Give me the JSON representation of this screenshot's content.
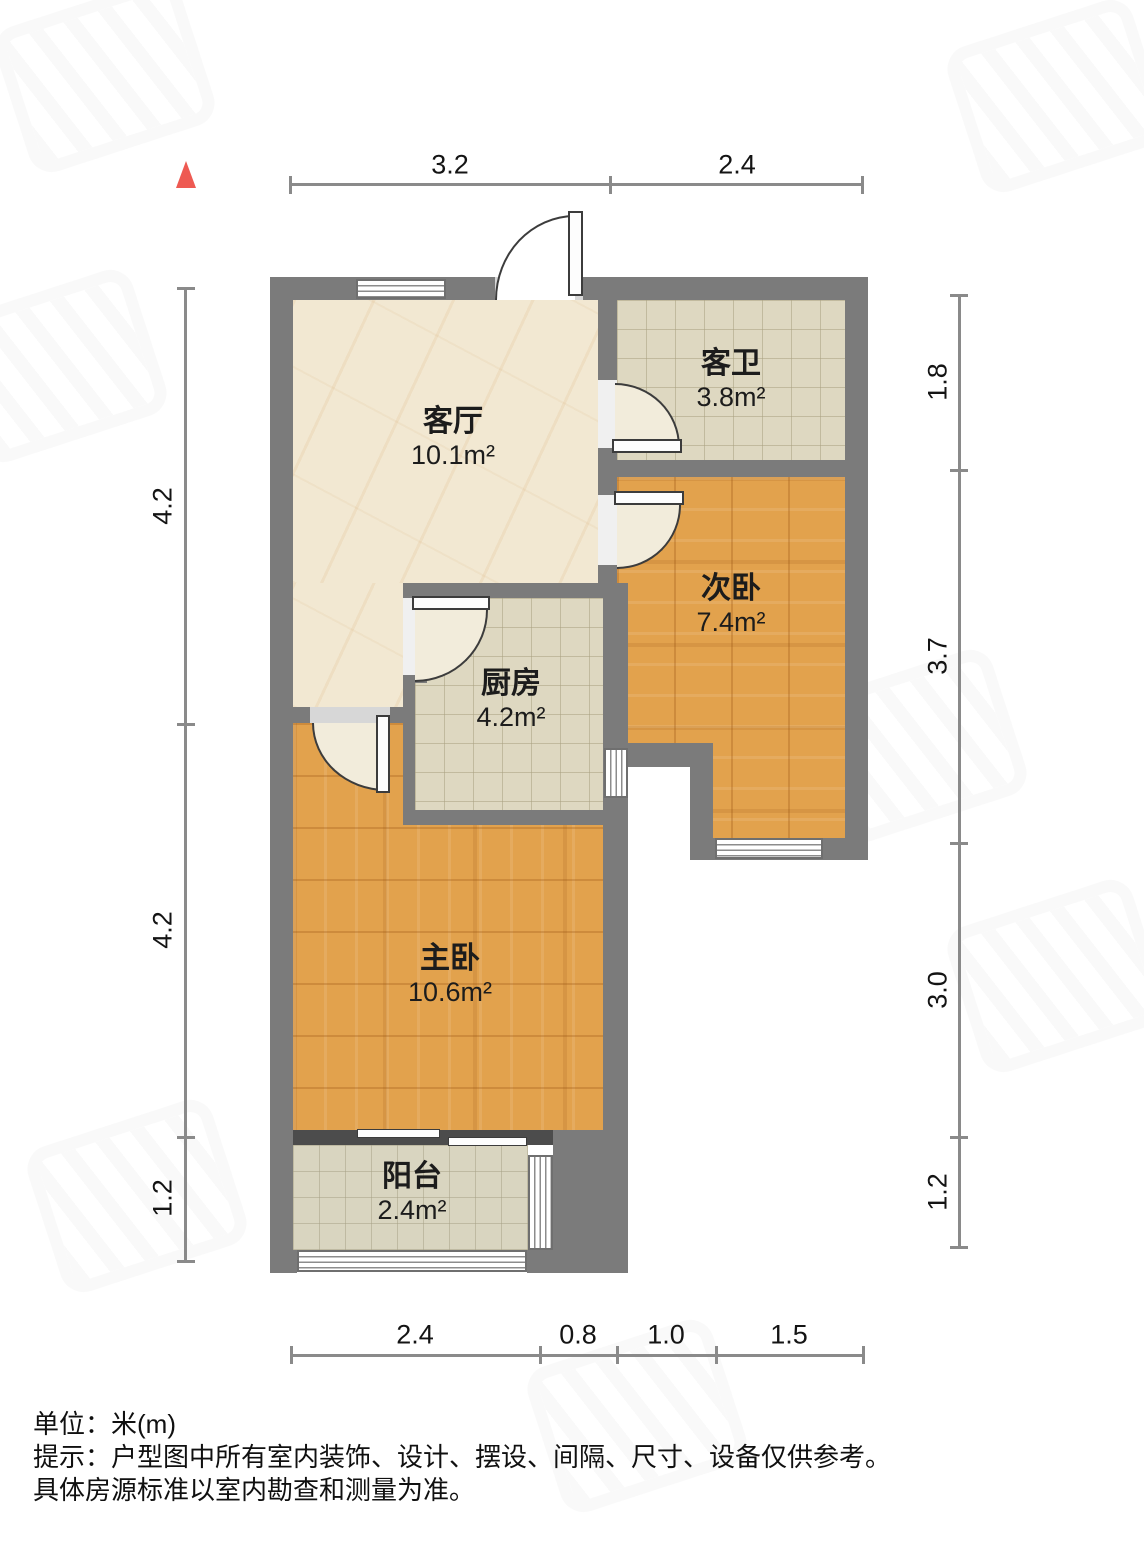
{
  "rooms": {
    "living": {
      "name": "客厅",
      "area": "10.1m²"
    },
    "bath": {
      "name": "客卫",
      "area": "3.8m²"
    },
    "bedroom2": {
      "name": "次卧",
      "area": "7.4m²"
    },
    "kitchen": {
      "name": "厨房",
      "area": "4.2m²"
    },
    "master": {
      "name": "主卧",
      "area": "10.6m²"
    },
    "balcony": {
      "name": "阳台",
      "area": "2.4m²"
    }
  },
  "dimensions": {
    "top": [
      "3.2",
      "2.4"
    ],
    "left": [
      "4.2",
      "4.2",
      "1.2"
    ],
    "right": [
      "1.8",
      "3.7",
      "3.0",
      "1.2"
    ],
    "bottom": [
      "2.4",
      "0.8",
      "1.0",
      "1.5"
    ]
  },
  "footer": {
    "unit": "单位：米(m)",
    "tip": "提示：户型图中所有室内装饰、设计、摆设、间隔、尺寸、设备仅供参考。",
    "tip2": "具体房源标准以室内勘查和测量为准。"
  },
  "colors": {
    "wall": "#7b7b7b",
    "wood_floor": "#e2a24d",
    "tile_floor": "#ded8c1",
    "marble_floor": "#f2e8d2",
    "balcony_floor": "#d9d5c0",
    "north_arrow": "#ee5a52",
    "dimension_line": "#8a8a8a"
  }
}
